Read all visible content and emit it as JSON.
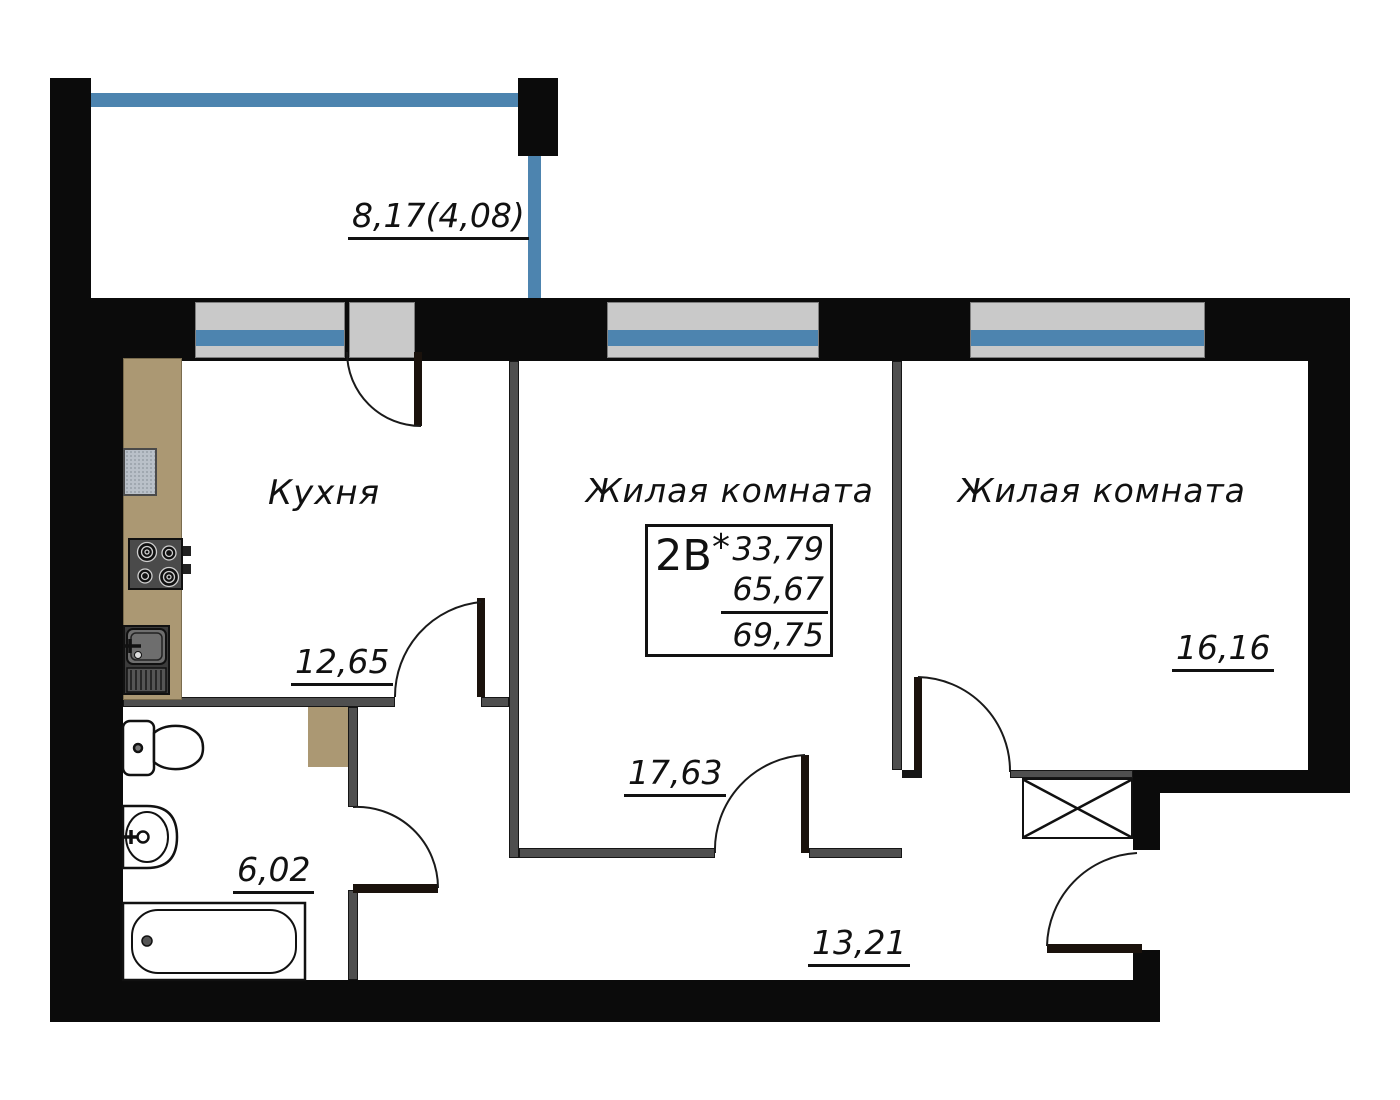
{
  "plan": {
    "balcony": {
      "area": "8,17(4,08)"
    },
    "kitchen": {
      "label": "Кухня",
      "area": "12,65"
    },
    "living_room_1": {
      "label": "Жилая комната",
      "area": "17,63"
    },
    "living_room_2": {
      "label": "Жилая комната",
      "area": "16,16"
    },
    "bathroom": {
      "area": "6,02"
    },
    "hallway": {
      "area": "13,21"
    }
  },
  "stamp": {
    "unit": "2В",
    "note_mark": "*",
    "area_1": "33,79",
    "area_2": "65,67",
    "area_total": "69,75"
  },
  "colors": {
    "wall": "#0b0b0b",
    "partition": "#4f4f4f",
    "glass_blue": "#4d84af",
    "frame_gray": "#c9c9c9",
    "counter_tan": "#ab9873",
    "text": "#111111"
  }
}
